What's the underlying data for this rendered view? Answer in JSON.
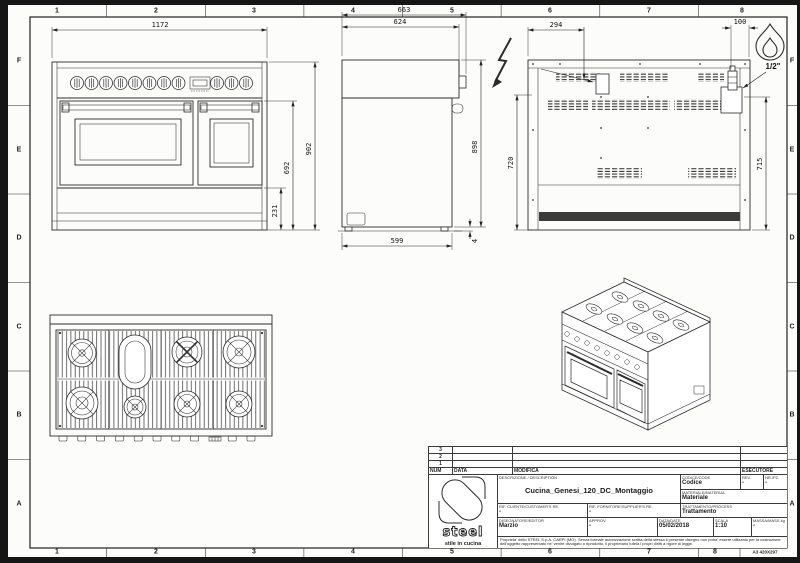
{
  "sheet": {
    "format_label": "A3 420X297",
    "columns": [
      "1",
      "2",
      "3",
      "4",
      "5",
      "6",
      "7",
      "8"
    ],
    "rows": [
      "F",
      "E",
      "D",
      "C",
      "B",
      "A"
    ]
  },
  "dimensions": {
    "front_width": "1172",
    "front_height_total": "902",
    "front_height_doors": "692",
    "front_height_base": "231",
    "side_depth_total": "663",
    "side_depth_top": "624",
    "side_height": "898",
    "side_depth_base": "599",
    "side_foot_height": "4",
    "rear_electric_offset": "294",
    "rear_gas_offset": "100",
    "rear_height_left": "720",
    "rear_height_right": "715",
    "gas_connection": "1/2\""
  },
  "title_block": {
    "revision_rows": [
      "3",
      "2",
      "1"
    ],
    "col_num": "NUM",
    "col_data": "DATA",
    "col_modifica": "MODIFICA",
    "col_esecutore": "ESECUTORE",
    "description_label": "DESCRIZIONE / DESCRIPTION",
    "description": "Cucina_Genesi_120_DC_Montaggio",
    "codice_label": "CODICE/CODE",
    "codice": "Codice",
    "rev_label": "REV.",
    "rev": "-",
    "nrpz_label": "NR./PZ.",
    "nrpz": "-",
    "materiale_label": "MATERIALE/MATERIAL",
    "materiale": "Materiale",
    "trattamento_label": "TRATTAMENTO/PROCESS",
    "trattamento": "Trattamento",
    "rif_cliente_label": "RIF. CLIENTE/CUSTOMER'S RE.",
    "rif_cliente": "-",
    "rif_fornitore_label": "RIF. FORNITORE/SUPPLIER'S RE.",
    "rif_fornitore": "-",
    "disegnatore_label": "DISEGNATORE/EDITOR",
    "disegnatore": "Marzio",
    "approv_label": "APPROV.",
    "approv": "-",
    "date_label": "DATA/DATE",
    "date": "05/02/2018",
    "scala_label": "SCALA",
    "scala": "1:10",
    "massa_label": "MASSA/MASS kg",
    "massa": "-",
    "legal": "Proprieta' dello STEEL S.p.A. CARPI (MO). Senza formale autorizzazione scritta della stessa il presente disegno non potra' essere utilizzato per la costruzione dell'oggetto rappresentato ne' venire divulgato o riprodotto, il proprietario tutela i propri diritti a rigore di legge.",
    "logo_text": "steel",
    "logo_tagline": "stile in cucina"
  }
}
